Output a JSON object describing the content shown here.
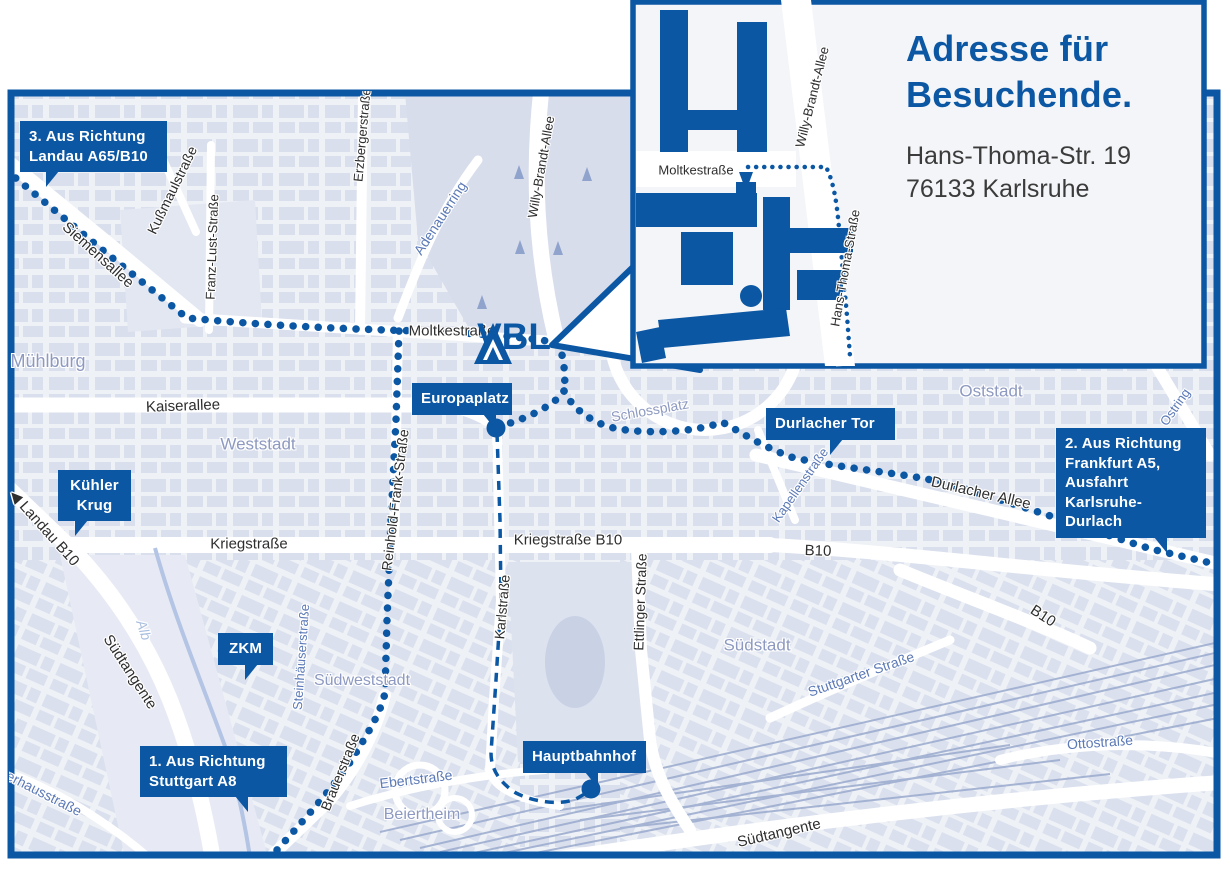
{
  "colors": {
    "brand_blue": "#0b57a4",
    "map_bg": "#eef1f6",
    "block_fill": "#d9dfec",
    "area_label": "#8d99c0",
    "street_blue_label": "#5b79b7",
    "water": "#a9bedf",
    "dark_label": "#2e2e2e",
    "road_white": "#ffffff",
    "rail": "#9aaace"
  },
  "brand": {
    "logo_text": "VBL"
  },
  "inset": {
    "title": [
      "Adresse für",
      "Besuchende."
    ],
    "address": [
      "Hans-Thoma-Str. 19",
      "76133 Karlsruhe"
    ],
    "street_labels": [
      {
        "text": "Moltkestraße",
        "x": 696,
        "y": 170,
        "r": 0,
        "cls": "dark",
        "size": 13
      },
      {
        "text": "Willy-Brandt-Allee",
        "x": 812,
        "y": 97,
        "r": -76,
        "cls": "dark",
        "size": 13
      },
      {
        "text": "Hans-Thoma-Straße",
        "x": 845,
        "y": 268,
        "r": -80,
        "cls": "dark",
        "size": 13
      }
    ]
  },
  "badges": [
    {
      "id": "route-3-landau",
      "lines": [
        "3. Aus Richtung",
        "Landau A65/B10"
      ],
      "x": 20,
      "y": 121,
      "w": 147,
      "tail": "dl",
      "tail_x": 26
    },
    {
      "id": "kuehler-krug",
      "lines": [
        "Kühler",
        "Krug"
      ],
      "x": 58,
      "y": 470,
      "w": 73,
      "center": true,
      "tail": "dl",
      "tail_x": 17
    },
    {
      "id": "zkm",
      "lines": [
        "ZKM"
      ],
      "x": 218,
      "y": 633,
      "w": 55,
      "center": true,
      "tail": "dl",
      "tail_x": 27
    },
    {
      "id": "route-1-stuttgart",
      "lines": [
        "1. Aus Richtung",
        "Stuttgart A8"
      ],
      "x": 140,
      "y": 746,
      "w": 147,
      "tail": "dr",
      "tail_x": 95
    },
    {
      "id": "europaplatz",
      "lines": [
        "Europaplatz"
      ],
      "x": 412,
      "y": 383,
      "w": 100,
      "tail": "dr",
      "tail_x": 71
    },
    {
      "id": "durlacher-tor",
      "lines": [
        "Durlacher Tor"
      ],
      "x": 766,
      "y": 408,
      "w": 129,
      "tail": "dl",
      "tail_x": 64
    },
    {
      "id": "route-2-frankfurt",
      "lines": [
        "2. Aus Richtung",
        "Frankfurt A5,",
        "Ausfahrt",
        "Karlsruhe-Durlach"
      ],
      "x": 1056,
      "y": 428,
      "w": 150,
      "tail": "dr",
      "tail_x": 98
    },
    {
      "id": "hauptbahnhof",
      "lines": [
        "Hauptbahnhof"
      ],
      "x": 523,
      "y": 741,
      "w": 123,
      "tail": "dr",
      "tail_x": 62
    }
  ],
  "map": {
    "street_labels": [
      {
        "text": "Siemensallee",
        "x": 98,
        "y": 255,
        "r": 42,
        "cls": "dark",
        "size": 15
      },
      {
        "text": "Kußmaulstraße",
        "x": 172,
        "y": 190,
        "r": -64,
        "cls": "dark",
        "size": 14
      },
      {
        "text": "Franz-Lust-Straße",
        "x": 212,
        "y": 247,
        "r": -88,
        "cls": "dark",
        "size": 13
      },
      {
        "text": "Erzbergerstraße",
        "x": 362,
        "y": 135,
        "r": -85,
        "cls": "dark",
        "size": 13
      },
      {
        "text": "Willy-Brandt-Allee",
        "x": 541,
        "y": 167,
        "r": -80,
        "cls": "dark",
        "size": 13
      },
      {
        "text": "Adenauerring",
        "x": 440,
        "y": 218,
        "r": -57,
        "cls": "blue",
        "size": 14
      },
      {
        "text": "Moltkestraße",
        "x": 452,
        "y": 331,
        "r": 0,
        "cls": "dark",
        "size": 15
      },
      {
        "text": "Kaiserallee",
        "x": 183,
        "y": 406,
        "r": -2,
        "cls": "dark",
        "size": 15
      },
      {
        "text": "Schlossplatz",
        "x": 650,
        "y": 410,
        "r": -10,
        "cls": "area",
        "size": 14
      },
      {
        "text": "Mühlburg",
        "x": 48,
        "y": 361,
        "r": 0,
        "cls": "area",
        "size": 18
      },
      {
        "text": "Weststadt",
        "x": 258,
        "y": 444,
        "r": 0,
        "cls": "area",
        "size": 17
      },
      {
        "text": "Oststadt",
        "x": 991,
        "y": 391,
        "r": 0,
        "cls": "area",
        "size": 17
      },
      {
        "text": "Ostring",
        "x": 1175,
        "y": 407,
        "r": -55,
        "cls": "blue",
        "size": 13
      },
      {
        "text": "Reinhold-Frank-Straße",
        "x": 395,
        "y": 500,
        "r": -83,
        "cls": "dark",
        "size": 14
      },
      {
        "text": "Kapellenstraße",
        "x": 800,
        "y": 485,
        "r": -55,
        "cls": "blue",
        "size": 13
      },
      {
        "text": "Durlacher Allee",
        "x": 981,
        "y": 493,
        "r": 13,
        "cls": "dark",
        "size": 15
      },
      {
        "text": "◀ Landau B10",
        "x": 44,
        "y": 528,
        "r": 48,
        "cls": "dark",
        "size": 15
      },
      {
        "text": "Kriegstraße",
        "x": 249,
        "y": 544,
        "r": 0,
        "cls": "dark",
        "size": 15
      },
      {
        "text": "Kriegstraße B10",
        "x": 568,
        "y": 540,
        "r": 0,
        "cls": "dark",
        "size": 15
      },
      {
        "text": "B10",
        "x": 818,
        "y": 551,
        "r": 2,
        "cls": "dark",
        "size": 15
      },
      {
        "text": "B10",
        "x": 1043,
        "y": 616,
        "r": 33,
        "cls": "dark",
        "size": 15
      },
      {
        "text": "Karlstraße",
        "x": 502,
        "y": 607,
        "r": -85,
        "cls": "dark",
        "size": 14
      },
      {
        "text": "Ettlinger Straße",
        "x": 640,
        "y": 602,
        "r": -88,
        "cls": "dark",
        "size": 14
      },
      {
        "text": "Südstadt",
        "x": 757,
        "y": 645,
        "r": 0,
        "cls": "area",
        "size": 17
      },
      {
        "text": "Stuttgarter Straße",
        "x": 861,
        "y": 674,
        "r": -19,
        "cls": "blue",
        "size": 14
      },
      {
        "text": "Steinhäuserstraße",
        "x": 301,
        "y": 657,
        "r": -86,
        "cls": "blue",
        "size": 13
      },
      {
        "text": "Südweststadt",
        "x": 362,
        "y": 681,
        "r": 0,
        "cls": "area",
        "size": 16
      },
      {
        "text": "Südtangente",
        "x": 130,
        "y": 672,
        "r": 57,
        "cls": "dark",
        "size": 15
      },
      {
        "text": "Alb",
        "x": 144,
        "y": 630,
        "r": 72,
        "cls": "water",
        "size": 14
      },
      {
        "text": "Brauerstraße",
        "x": 340,
        "y": 772,
        "r": -68,
        "cls": "dark",
        "size": 14
      },
      {
        "text": "Ebertstraße",
        "x": 416,
        "y": 779,
        "r": -7,
        "cls": "blue",
        "size": 14
      },
      {
        "text": "Beiertheim",
        "x": 422,
        "y": 815,
        "r": 0,
        "cls": "area",
        "size": 16
      },
      {
        "text": "Südtangente",
        "x": 779,
        "y": 833,
        "r": -13,
        "cls": "dark",
        "size": 15
      },
      {
        "text": "Ottostraße",
        "x": 1100,
        "y": 742,
        "r": -4,
        "cls": "blue",
        "size": 14
      },
      {
        "text": "Pulverhausstraße",
        "x": 32,
        "y": 787,
        "r": 27,
        "cls": "blue",
        "size": 14
      }
    ]
  },
  "routes": {
    "landau": {
      "name": "Route 3 Landau A65/B10 via Siemensallee / Moltkestraße",
      "d": "M 6 170 L 100 248 L 187 318 C 260 325 340 329 420 331 C 470 333 520 336 559 343"
    },
    "vbl_link": {
      "name": "link from Moltkestraße down to Europaplatz fork",
      "d": "M 559 343 C 564 360 566 377 564 391"
    },
    "to_europaplatz": {
      "name": "fork to Europaplatz",
      "d": "M 564 391 C 554 407 520 421 500 426"
    },
    "frankfurt": {
      "name": "Route 2 Frankfurt A5 via Durlacher Tor / Durlacher Allee",
      "d": "M 564 391 C 573 408 586 418 606 426 C 636 435 696 433 722 422 C 741 432 757 444 791 457 C 831 467 901 473 936 481 C 1001 498 1081 527 1151 549 L 1228 567"
    },
    "stuttgart": {
      "name": "Route 1 Stuttgart A8 via Brauerstraße / Reinhold-Frank-Straße",
      "d": "M 399 331 L 396 420 L 391 520 L 387 620 L 385 693 C 380 714 369 731 354 756 C 339 781 299 826 257 872"
    },
    "tram": {
      "name": "dashed link Europaplatz – Karlstraße – Hauptbahnhof",
      "d": "M 497 433 L 500 520 L 501 600 L 496 680 L 491 753 C 491 769 499 782 516 793 C 536 803 561 805 576 799 L 588 792"
    },
    "inset_arrival": {
      "name": "arrival route on detail map along Hans-Thoma-Straße",
      "d": "M 748 167 L 826 167 C 834 182 837 205 839 228 L 843 272 L 847 316 L 850 356"
    }
  }
}
